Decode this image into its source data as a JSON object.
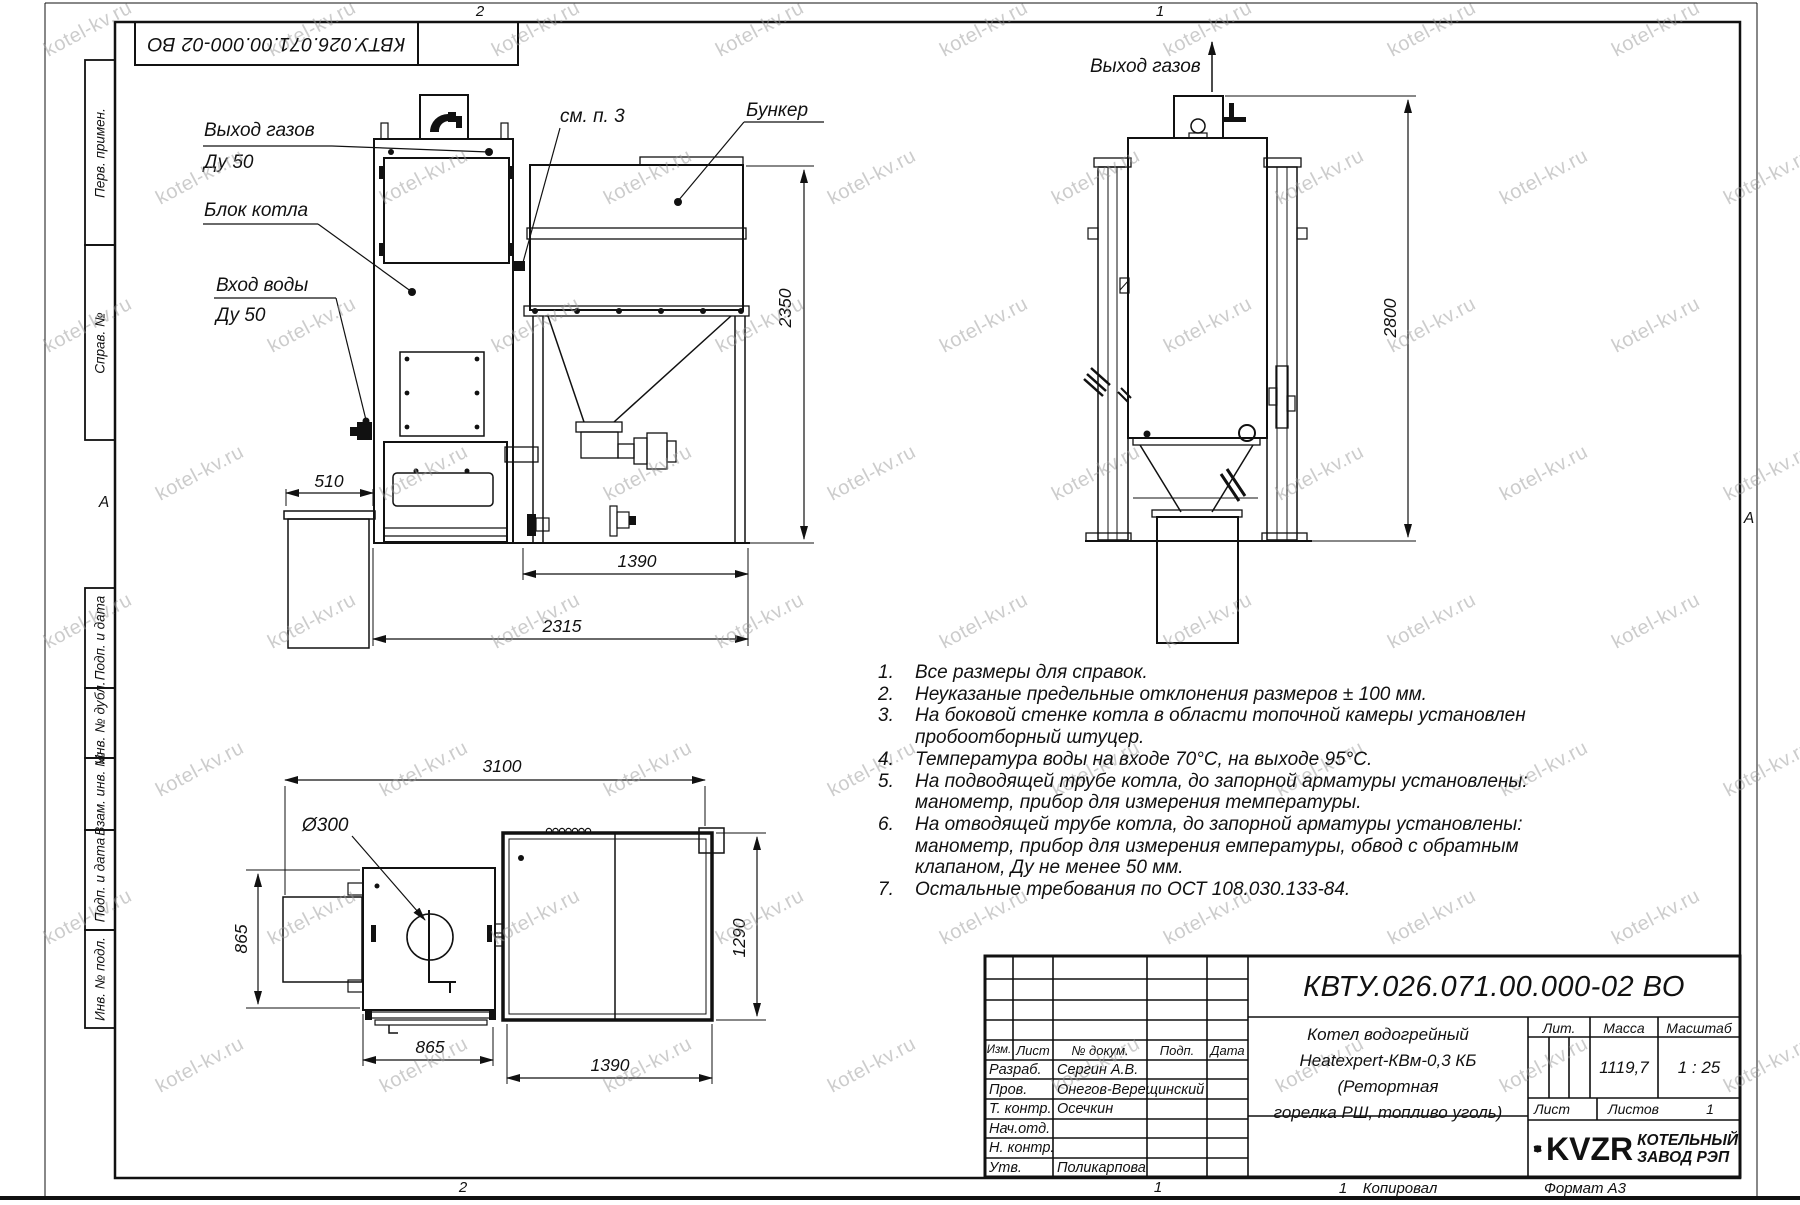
{
  "sheet": {
    "watermark_text": "kotel-kv.ru",
    "zone_top_left": "2",
    "zone_top_right": "1",
    "zone_bottom_left": "2",
    "zone_bottom_right": "1",
    "fold_marker_left": "А",
    "fold_marker_right": "А",
    "designation_inverted": "КВТУ.026.071.00.000-02 ВО",
    "sheet_no_footer": "1",
    "copied_label": "Копировал",
    "format_label": "Формат А3"
  },
  "side_column": {
    "labels": [
      "Перв. примен.",
      "Справ. №",
      "Подп. и дата",
      "Инв. № дубл.",
      "Взам. инв. №",
      "Подп. и дата",
      "Инв. № подл."
    ]
  },
  "views": {
    "front": {
      "callout_gas_outlet": "Выход газов",
      "callout_gas_outlet_dn": "Ду 50",
      "callout_boiler_block": "Блок котла",
      "callout_water_inlet": "Вход воды",
      "callout_water_inlet_dn": "Ду 50",
      "callout_see_note": "см. п. 3",
      "callout_bunker": "Бункер",
      "dim_510": "510",
      "dim_1390": "1390",
      "dim_2315": "2315",
      "dim_2350": "2350"
    },
    "side": {
      "callout_gas_outlet": "Выход газов",
      "dim_2800": "2800"
    },
    "plan": {
      "dim_3100": "3100",
      "dim_d300": "Ø300",
      "dim_865_left": "865",
      "dim_865_bottom": "865",
      "dim_1390": "1390",
      "dim_1290": "1290"
    }
  },
  "notes": [
    {
      "num": "1.",
      "text": "Все размеры для справок."
    },
    {
      "num": "2.",
      "text": "Неуказаные предельные отклонения размеров ± 100 мм."
    },
    {
      "num": "3.",
      "text": "На боковой стенке котла в области топочной камеры установлен пробоотборный штуцер."
    },
    {
      "num": "4.",
      "text": "Температура воды на входе 70°С, на выходе 95°С."
    },
    {
      "num": "5.",
      "text": "На подводящей трубе котла, до запорной арматуры установлены: манометр, прибор для измерения температуры."
    },
    {
      "num": "6.",
      "text": "На отводящей трубе котла, до запорной арматуры установлены: манометр, прибор для измерения емпературы, обвод с обратным клапаном, Ду не менее 50 мм."
    },
    {
      "num": "7.",
      "text": "Остальные требования по ОСТ 108.030.133-84."
    }
  ],
  "title_block": {
    "designation": "КВТУ.026.071.00.000-02 ВО",
    "product_name_lines": [
      "Котел водогрейный",
      "Heatexpert-КВм-0,3 КБ (Ретортная",
      "горелка РШ, топливо уголь)"
    ],
    "col_izm": "Изм.",
    "col_list": "Лист",
    "col_doc": "№ докум.",
    "col_podp": "Подп.",
    "col_data": "Дата",
    "lit_label": "Лит.",
    "mass_label": "Масса",
    "scale_label": "Масштаб",
    "mass_value": "1119,7",
    "scale_value": "1 : 25",
    "sheet_label": "Лист",
    "sheets_label": "Листов",
    "sheets_value": "1",
    "sign_rows": [
      {
        "role": "Разраб.",
        "name": "Сергин А.В."
      },
      {
        "role": "Пров.",
        "name": "Онегов-Верещинский"
      },
      {
        "role": "Т. контр.",
        "name": "Осечкин"
      },
      {
        "role": "Нач.отд.",
        "name": ""
      },
      {
        "role": "Н. контр.",
        "name": ""
      },
      {
        "role": "Утв.",
        "name": "Поликарпова"
      }
    ],
    "logo_text": "KVZR",
    "company_line1": "КОТЕЛЬНЫЙ",
    "company_line2": "ЗАВОД РЭП"
  }
}
